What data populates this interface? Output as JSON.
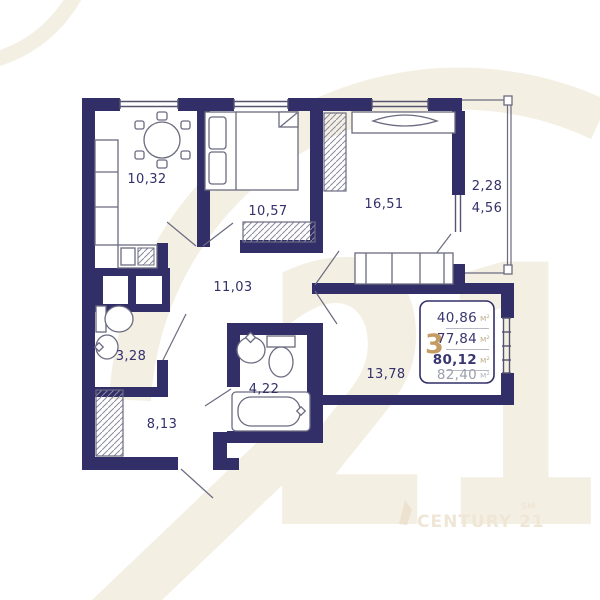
{
  "plan": {
    "rooms": {
      "kitchen": {
        "area": "10,32"
      },
      "bedroom": {
        "area": "10,57"
      },
      "living": {
        "area": "16,51"
      },
      "hallway": {
        "area": "11,03"
      },
      "wc": {
        "area": "3,28"
      },
      "bedroom2": {
        "area": "8,13"
      },
      "bathroom": {
        "area": "4,22"
      },
      "corridor": {
        "area": "13,78"
      },
      "balcony": {
        "area_reduced": "2,28",
        "area_full": "4,56"
      }
    }
  },
  "info_box": {
    "rooms_count": "3",
    "unit": "м²",
    "living_area": "40,86",
    "area_without_balcony": "77,84",
    "area_main": "80,12",
    "area_total": "82,40"
  },
  "watermark": {
    "big_digits": "21",
    "brand": "CENTURY 21",
    "service_mark": "SM"
  },
  "colors": {
    "wall": "#312e68",
    "label": "#33306a",
    "accent_gold": "#c49b62",
    "watermark_beige": "#f4efe3"
  }
}
